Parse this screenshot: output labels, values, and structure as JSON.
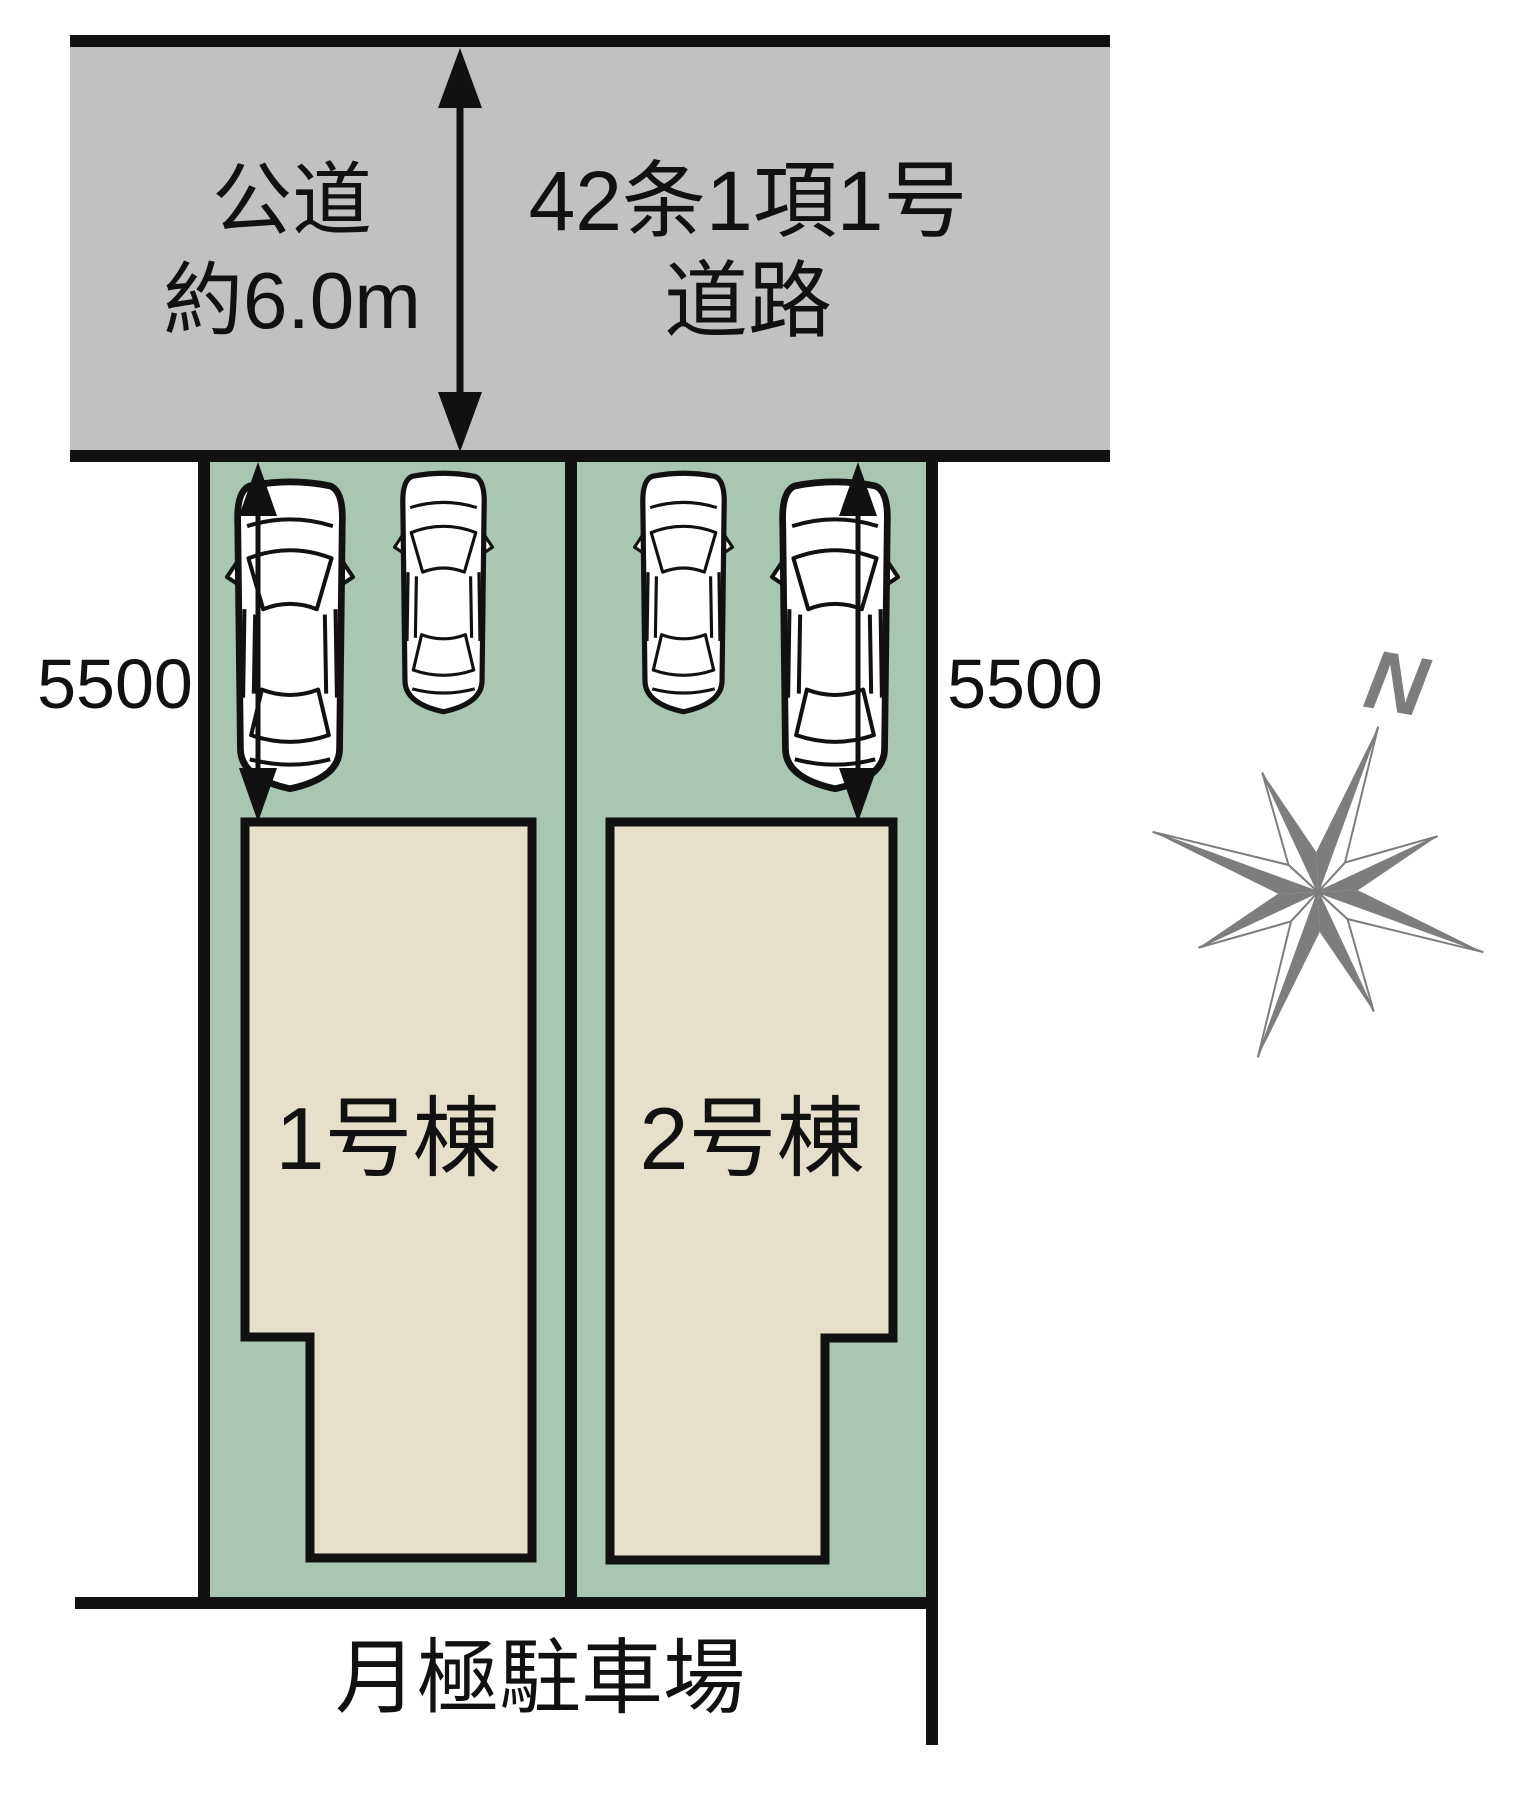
{
  "road": {
    "surface_label_line1": "公道",
    "surface_label_line2": "約6.0m",
    "type_label_line1": "42条1項1号",
    "type_label_line2": "道路"
  },
  "plots": {
    "depth_dimension_left": "5500",
    "depth_dimension_right": "5500",
    "building1_label": "1号棟",
    "building2_label": "2号棟"
  },
  "south_area_label": "月極駐車場",
  "compass": {
    "north_label": "N"
  },
  "colors": {
    "road_fill": "#c1c1c1",
    "plot_fill": "#a8c6b2",
    "building_fill": "#e5dfcc",
    "line": "#111111",
    "compass_gray": "#7d7d7d",
    "car_fill": "#ffffff",
    "background": "#ffffff"
  }
}
